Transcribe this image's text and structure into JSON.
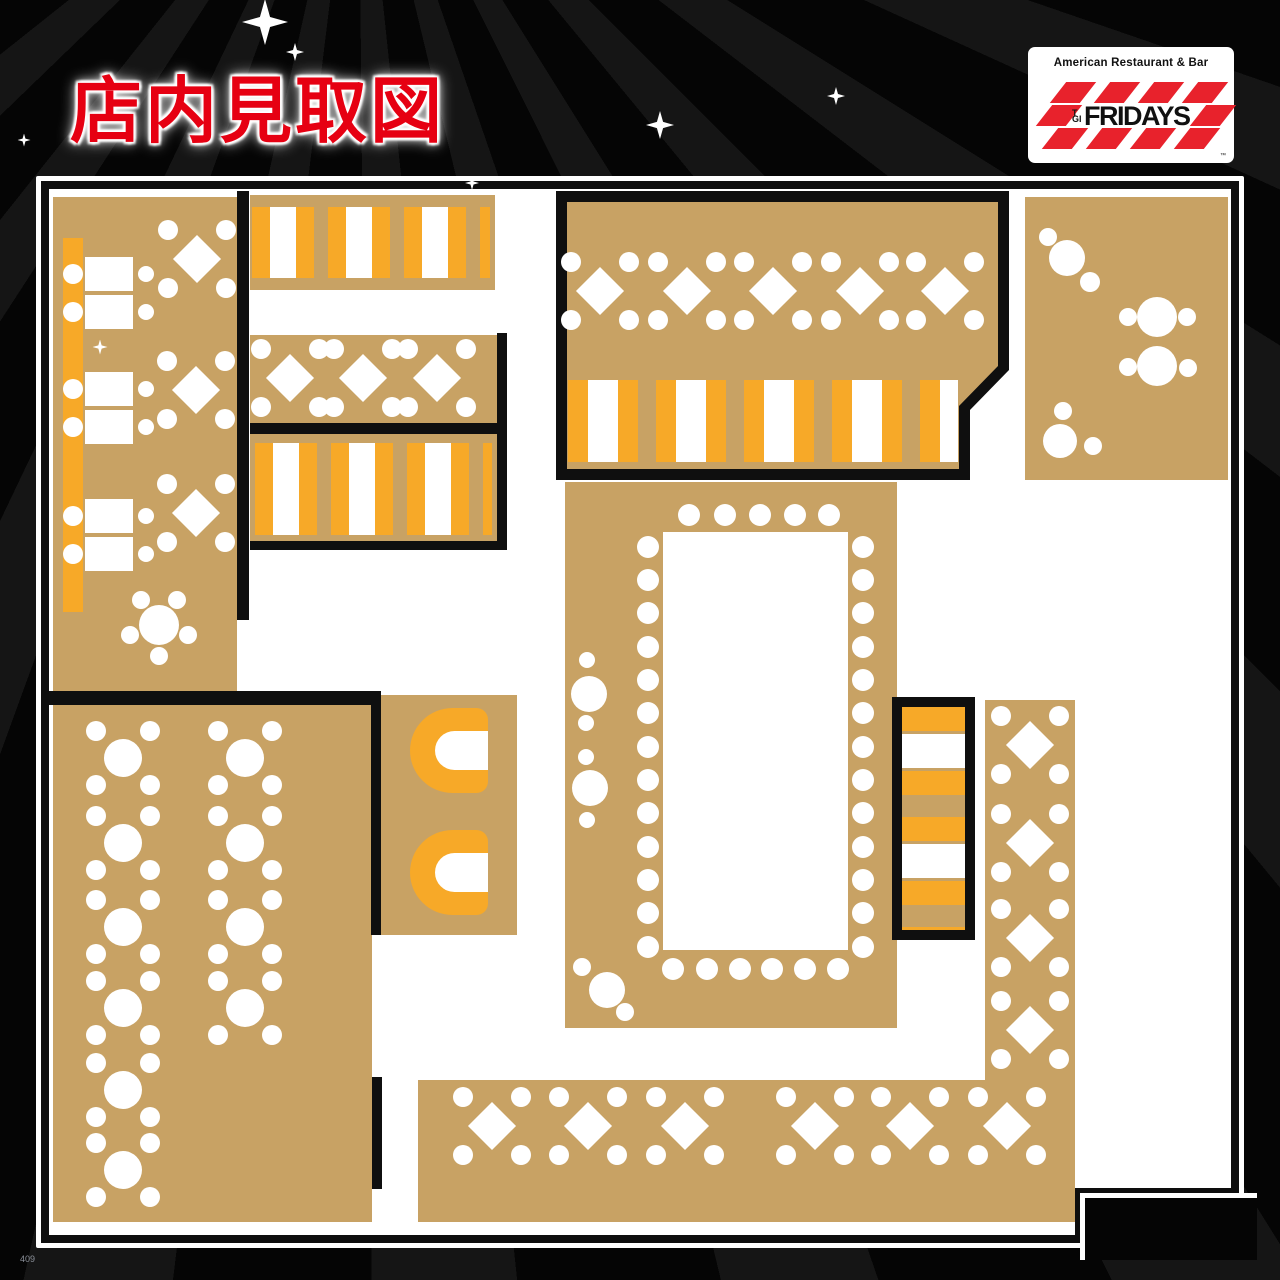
{
  "title": {
    "text": "店内見取図"
  },
  "logo": {
    "tagline": "American Restaurant & Bar",
    "brand_tgi": "TGI",
    "brand_name": "FRIDAYS",
    "trademark": "™"
  },
  "footer": {
    "page_note": "409"
  },
  "colors": {
    "title_red": "#e60012",
    "logo_red": "#e8222c",
    "seating_tan": "#c8a264",
    "booth_orange": "#f7a928",
    "wall_black": "#0f0f0f",
    "floor_white": "#ffffff",
    "background": "#050505"
  },
  "floorplan": {
    "description": "TGI Fridays restaurant interior seating floor plan",
    "diamond_tables": [
      [
        197,
        259
      ],
      [
        196,
        390
      ],
      [
        196,
        513
      ],
      [
        290,
        378
      ],
      [
        363,
        378
      ],
      [
        437,
        378
      ],
      [
        600,
        291
      ],
      [
        687,
        291
      ],
      [
        773,
        291
      ],
      [
        860,
        291
      ],
      [
        945,
        291
      ],
      [
        1030,
        745
      ],
      [
        1030,
        843
      ],
      [
        1030,
        938
      ],
      [
        1030,
        1030
      ],
      [
        492,
        1126
      ],
      [
        588,
        1126
      ],
      [
        685,
        1126
      ],
      [
        815,
        1126
      ],
      [
        910,
        1126
      ],
      [
        1007,
        1126
      ]
    ],
    "round_tables_4top": [
      [
        123,
        758
      ],
      [
        245,
        758
      ],
      [
        123,
        843
      ],
      [
        245,
        843
      ],
      [
        123,
        927
      ],
      [
        245,
        927
      ],
      [
        123,
        1008
      ],
      [
        245,
        1008
      ],
      [
        123,
        1090
      ],
      [
        123,
        1170
      ]
    ],
    "round_tables_small": [
      {
        "x": 159,
        "y": 625,
        "r": 20,
        "sats": [
          [
            -18,
            -25,
            9
          ],
          [
            18,
            -25,
            9
          ],
          [
            -29,
            10,
            9
          ],
          [
            29,
            10,
            9
          ],
          [
            0,
            31,
            9
          ]
        ]
      },
      {
        "x": 589,
        "y": 694,
        "r": 18,
        "sats": [
          [
            -2,
            -34,
            8
          ],
          [
            -3,
            29,
            8
          ]
        ]
      },
      {
        "x": 590,
        "y": 788,
        "r": 18,
        "sats": [
          [
            -4,
            -31,
            8
          ],
          [
            -3,
            32,
            8
          ]
        ]
      },
      {
        "x": 607,
        "y": 990,
        "r": 18,
        "sats": [
          [
            -25,
            -23,
            9
          ],
          [
            18,
            22,
            9
          ]
        ]
      },
      {
        "x": 1067,
        "y": 258,
        "r": 18,
        "sats": [
          [
            -19,
            -21,
            9
          ],
          [
            23,
            24,
            10
          ]
        ]
      },
      {
        "x": 1157,
        "y": 317,
        "r": 20,
        "sats": [
          [
            -29,
            0,
            9
          ],
          [
            30,
            0,
            9
          ]
        ]
      },
      {
        "x": 1157,
        "y": 366,
        "r": 20,
        "sats": [
          [
            -29,
            1,
            9
          ],
          [
            31,
            2,
            9
          ]
        ]
      },
      {
        "x": 1060,
        "y": 441,
        "r": 17,
        "sats": [
          [
            3,
            -30,
            9
          ],
          [
            33,
            5,
            9
          ]
        ]
      }
    ],
    "rect_tables": [
      [
        85,
        257
      ],
      [
        85,
        295
      ],
      [
        85,
        372
      ],
      [
        85,
        410
      ],
      [
        85,
        499
      ],
      [
        85,
        537
      ]
    ],
    "party_table": {
      "rect": [
        663,
        532,
        185,
        418
      ],
      "top_dots_y": 515,
      "top_dots_x": [
        689,
        725,
        760,
        795,
        829
      ],
      "bottom_dots_y": 969,
      "bottom_dots_x": [
        673,
        707,
        740,
        772,
        805,
        838
      ],
      "left_dots_x": 648,
      "right_dots_x": 863,
      "side_dots_y": [
        547,
        580,
        613,
        647,
        680,
        713,
        747,
        780,
        813,
        847,
        880,
        913,
        947
      ]
    },
    "sparkles": [
      [
        265,
        22,
        46
      ],
      [
        295,
        52,
        18
      ],
      [
        660,
        125,
        28
      ],
      [
        836,
        96,
        18
      ],
      [
        100,
        347,
        15
      ],
      [
        472,
        183,
        14
      ],
      [
        24,
        140,
        13
      ]
    ]
  }
}
